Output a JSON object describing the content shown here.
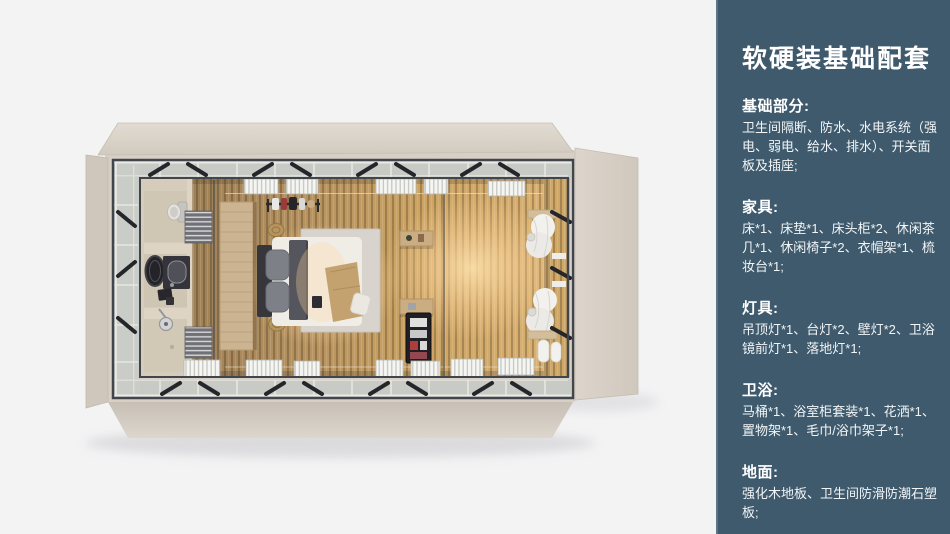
{
  "palette": {
    "canvas_bg": "#f3f3f4",
    "sidebar_bg": "#3e5a6c",
    "sidebar_text": "#ffffff",
    "shell_beige": "#d8d0c6",
    "glass_band": "#c7cac5",
    "frame_dark": "#41454c",
    "floor_wood": "#c19a5f",
    "warm_glow": "#ffd9a0"
  },
  "sidebar": {
    "title": "软硬装基础配套",
    "sections": [
      {
        "label": "基础部分:",
        "body": "卫生间隔断、防水、水电系统（强电、弱电、给水、排水）、开关面板及插座;"
      },
      {
        "label": "家具:",
        "body": "床*1、床垫*1、床头柜*2、休闲茶几*1、休闲椅子*2、衣帽架*1、梳妆台*1;"
      },
      {
        "label": "灯具:",
        "body": "吊顶灯*1、台灯*2、壁灯*2、卫浴镜前灯*1、落地灯*1;"
      },
      {
        "label": "卫浴:",
        "body": "马桶*1、浴室柜套装*1、花洒*1、置物架*1、毛巾/浴巾架子*1;"
      },
      {
        "label": "地面:",
        "body": "强化木地板、卫生间防滑防潮石塑板;"
      }
    ]
  },
  "floorplan": {
    "view": "top-down-room-render",
    "objects": [
      "container-shell",
      "window-walls",
      "wood-floor",
      "bathroom",
      "toilet",
      "vanity-mirror",
      "shower",
      "wardrobe-panel",
      "coat-rack",
      "double-bed",
      "rug",
      "poufs",
      "side-shelves",
      "minibar",
      "window-blinds",
      "curtains",
      "towel-rolls"
    ]
  }
}
